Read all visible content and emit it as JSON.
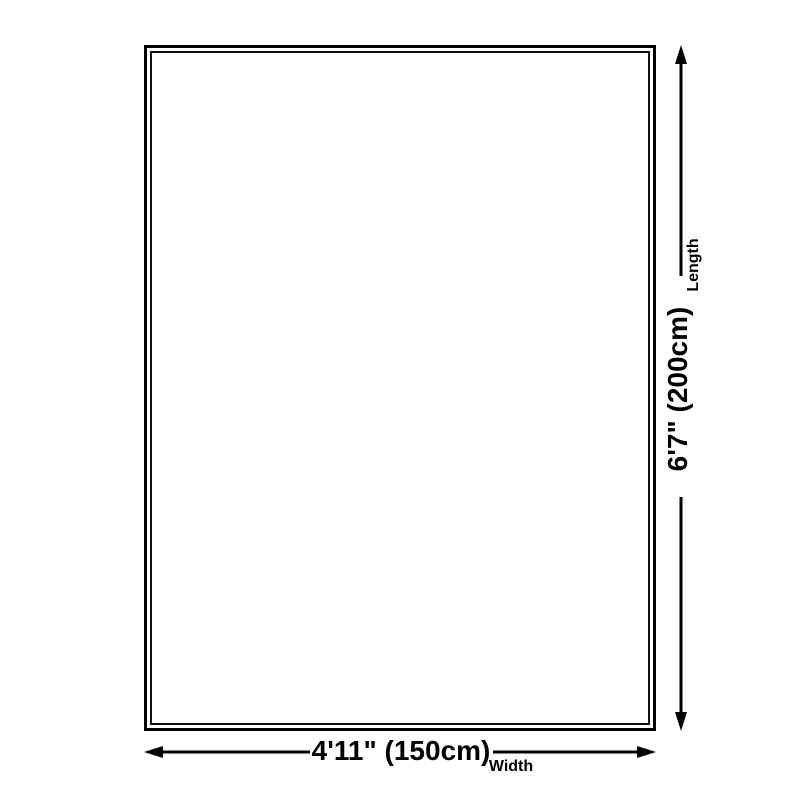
{
  "colors": {
    "background": "#ffffff",
    "line": "#000000",
    "text": "#000000"
  },
  "diagram": {
    "length": {
      "value": "6'7\" (200cm)",
      "label": "Length"
    },
    "width": {
      "value": "4'11\" (150cm)",
      "label": "Width"
    }
  }
}
